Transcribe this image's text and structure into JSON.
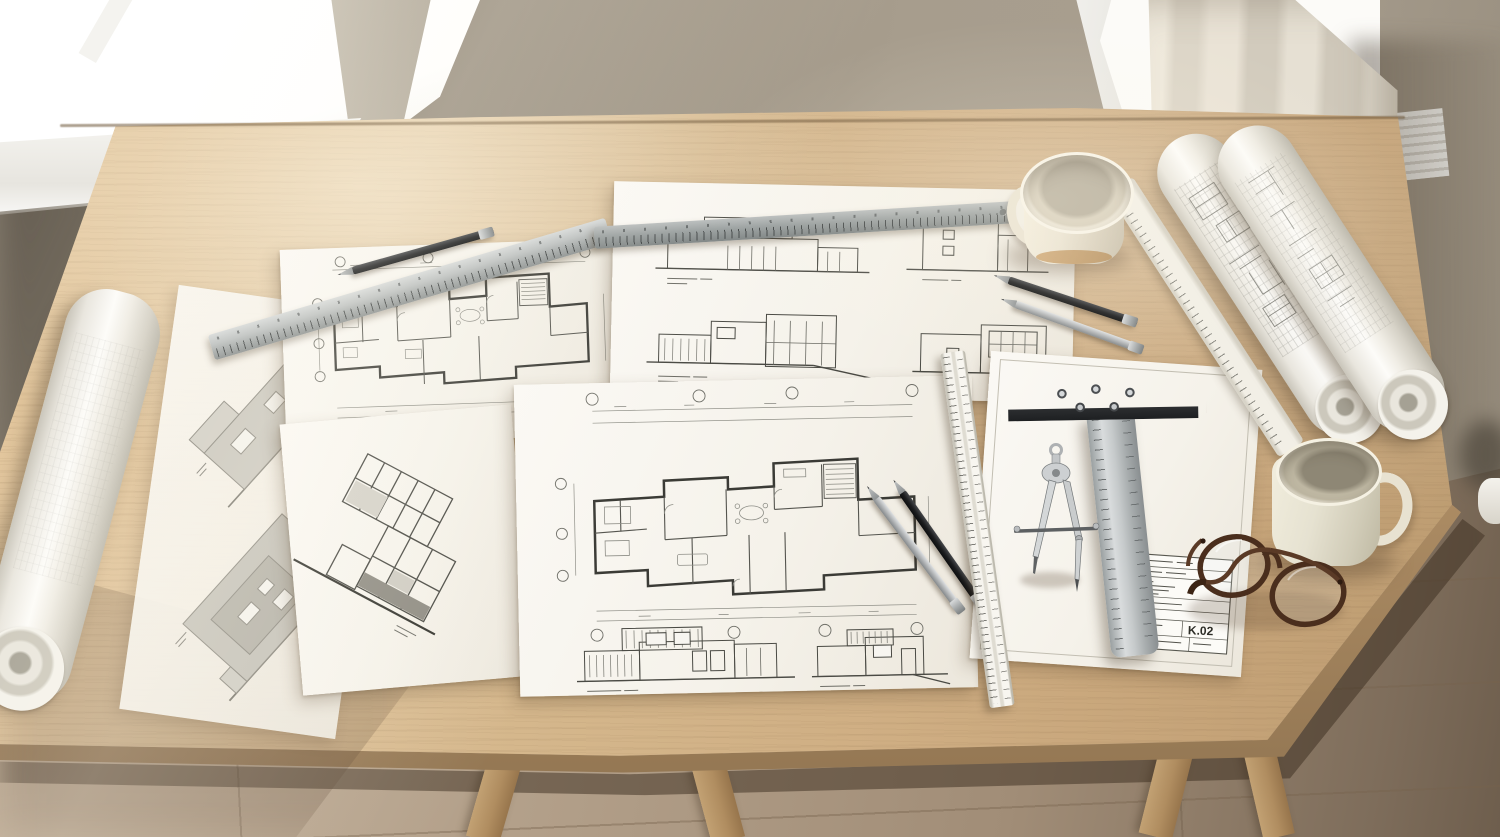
{
  "scene": {
    "title": "Architect's desk with blueprints and drafting tools",
    "description": "Angled top-down photograph of a light oak desk beside two daylight windows. Blueprint sheets with floor plans, elevations and a building section are spread across the desk together with rolled drawings, steel rulers, a scale ruler, a T-square, a drafting compass, mechanical pencils, two ceramic mugs and a pair of tortoiseshell glasses.",
    "lighting": "soft daylight from the upper left"
  },
  "palette": {
    "wall": "#9b9183",
    "window_glass": "#fcfbf8",
    "curtain": "#ddd6c8",
    "table_wood": "#d2b48a",
    "floor_wood": "#b3a08a",
    "paper": "#f6f4ef",
    "tracing_paper": "#f2efe8",
    "blueprint_ink": "#45453f",
    "steel": "#aeb2b2",
    "tsquare_head": "#54585b",
    "pencil_black": "#1b1c1e",
    "pencil_silver": "#b7b9bb",
    "ceramic": "#e9e2d2",
    "glasses_tortoise": "#5e3c28"
  },
  "title_block": {
    "drawing_number": "K.02"
  },
  "objects": [
    {
      "name": "table",
      "label": "light oak drafting table"
    },
    {
      "name": "sheet-left-plan",
      "label": "blueprint sheet with upper floor plan"
    },
    {
      "name": "sheet-elevations",
      "label": "blueprint sheet with four house elevations"
    },
    {
      "name": "sheet-main-plan",
      "label": "large blueprint sheet with ground floor plan and two elevations"
    },
    {
      "name": "sheet-title-block",
      "label": "blueprint sheet with title block"
    },
    {
      "name": "sheet-section",
      "label": "small sheet with tilted building section drawing"
    },
    {
      "name": "sheet-tracing",
      "label": "tracing paper sheet with two grey elevation studies"
    },
    {
      "name": "roll-left",
      "label": "partially unrolled tracing paper roll"
    },
    {
      "name": "roll-right-1",
      "label": "rolled blueprint"
    },
    {
      "name": "roll-right-2",
      "label": "rolled blueprint"
    },
    {
      "name": "ruler-steel-long",
      "label": "stainless steel ruler"
    },
    {
      "name": "ruler-steel-short",
      "label": "stainless steel ruler"
    },
    {
      "name": "ruler-ivory",
      "label": "ivory drafting ruler"
    },
    {
      "name": "ruler-scale",
      "label": "white triangular scale ruler"
    },
    {
      "name": "tsquare",
      "label": "T-square with dark head and steel blade"
    },
    {
      "name": "compass",
      "label": "silver drafting compass"
    },
    {
      "name": "pencil-black-1",
      "label": "black mechanical pencil"
    },
    {
      "name": "pencil-black-2",
      "label": "black mechanical pencil"
    },
    {
      "name": "pencil-silver-1",
      "label": "silver mechanical pencil"
    },
    {
      "name": "pencil-black-3",
      "label": "black mechanical pencil"
    },
    {
      "name": "pencil-silver-2",
      "label": "silver mechanical pencil"
    },
    {
      "name": "mug-top",
      "label": "cream ceramic mug"
    },
    {
      "name": "mug-right",
      "label": "cream ceramic mug"
    },
    {
      "name": "glasses",
      "label": "round tortoiseshell glasses, folded"
    },
    {
      "name": "window-left",
      "label": "bright window"
    },
    {
      "name": "window-right",
      "label": "window with sheer curtain"
    },
    {
      "name": "floor",
      "label": "oak plank floor"
    }
  ]
}
